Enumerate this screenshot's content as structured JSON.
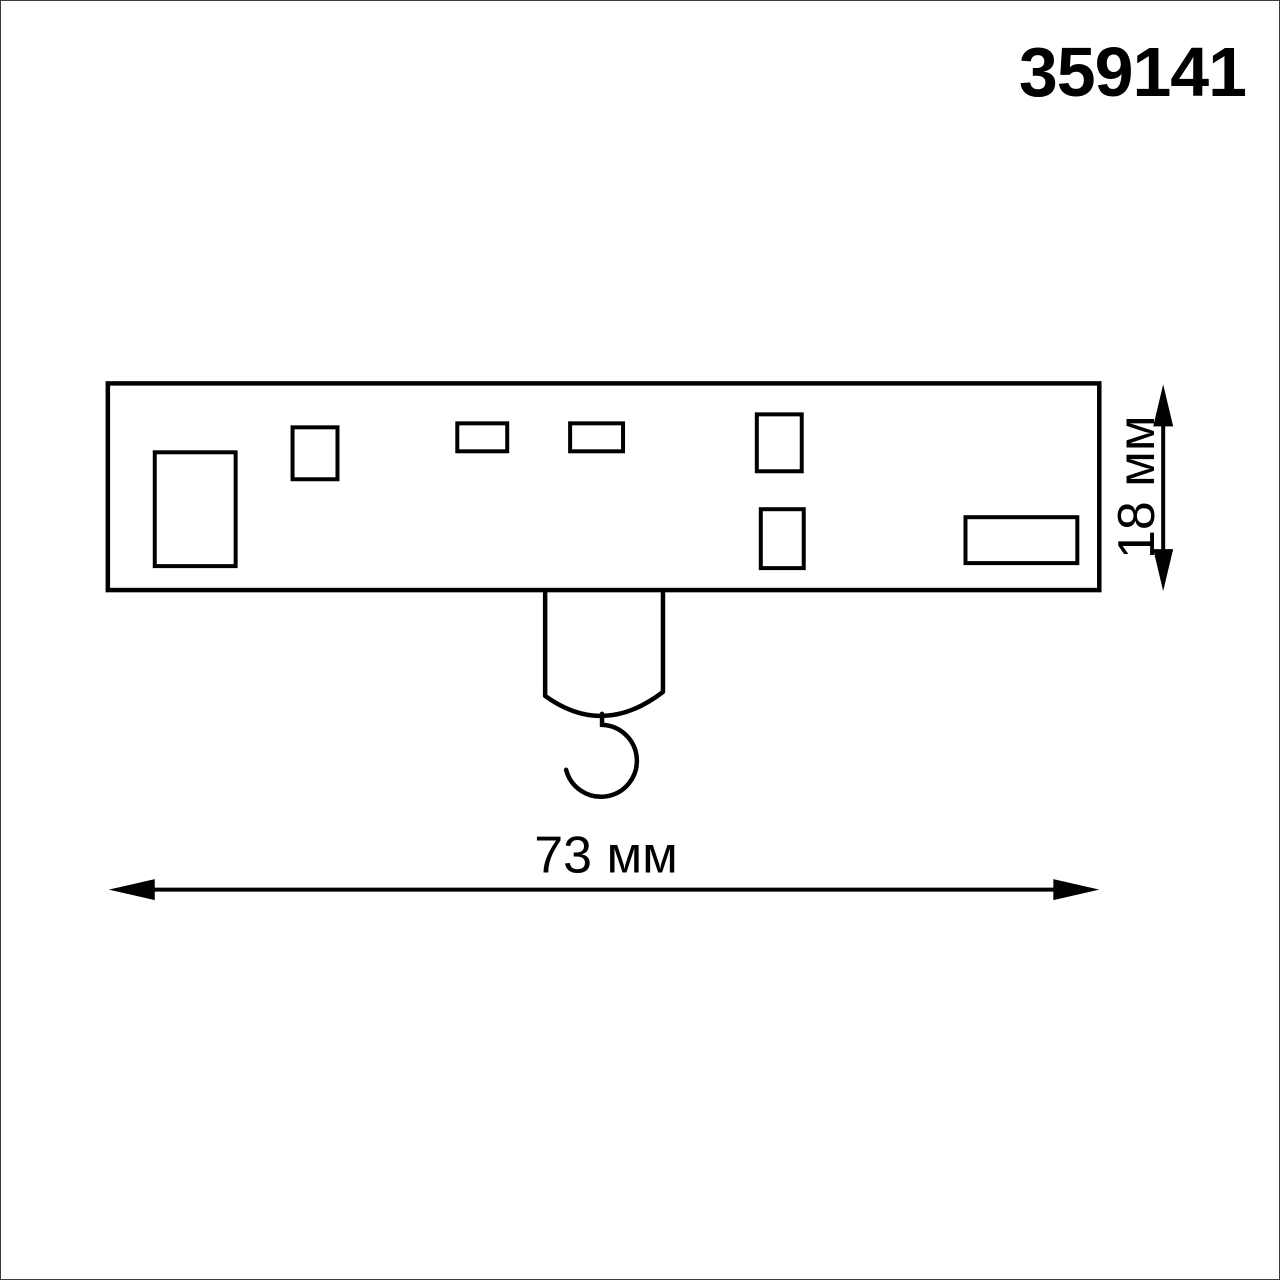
{
  "product_code": "359141",
  "dimensions": {
    "width": "73 мм",
    "height": "18 мм"
  },
  "colors": {
    "line": "#000000",
    "background": "#ffffff",
    "frame": "#3c3c3c"
  }
}
